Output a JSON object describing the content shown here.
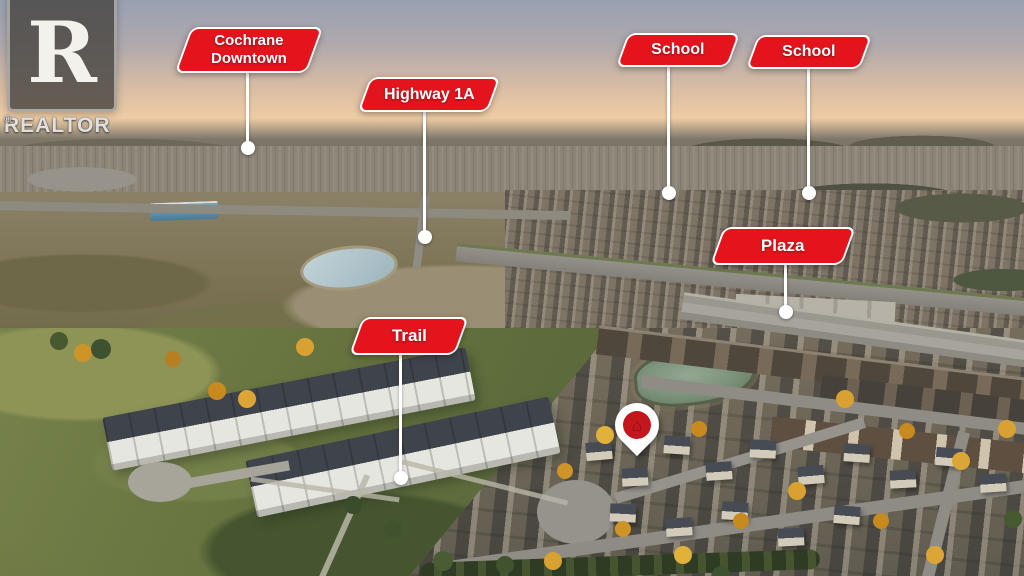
{
  "watermark": {
    "logo_letter": "R",
    "brand_name": "REALTOR",
    "registered_symbol": "®"
  },
  "labels": [
    {
      "id": "cochrane-downtown",
      "lines": [
        "Cochrane",
        "Downtown"
      ]
    },
    {
      "id": "highway-1a",
      "lines": [
        "Highway 1A"
      ]
    },
    {
      "id": "school-west",
      "lines": [
        "School"
      ]
    },
    {
      "id": "school-east",
      "lines": [
        "School"
      ]
    },
    {
      "id": "plaza",
      "lines": [
        "Plaza"
      ]
    },
    {
      "id": "trail",
      "lines": [
        "Trail"
      ]
    }
  ],
  "map_pin": {
    "icon": "house-icon",
    "glyph": "⌂"
  },
  "colors": {
    "label_background": "#e4141d",
    "label_border": "#ffffff",
    "label_text": "#ffffff",
    "leader_line": "#ffffff",
    "pin_body": "#ffffff",
    "pin_circle": "#c4161d",
    "pin_house": "#8a1015"
  }
}
